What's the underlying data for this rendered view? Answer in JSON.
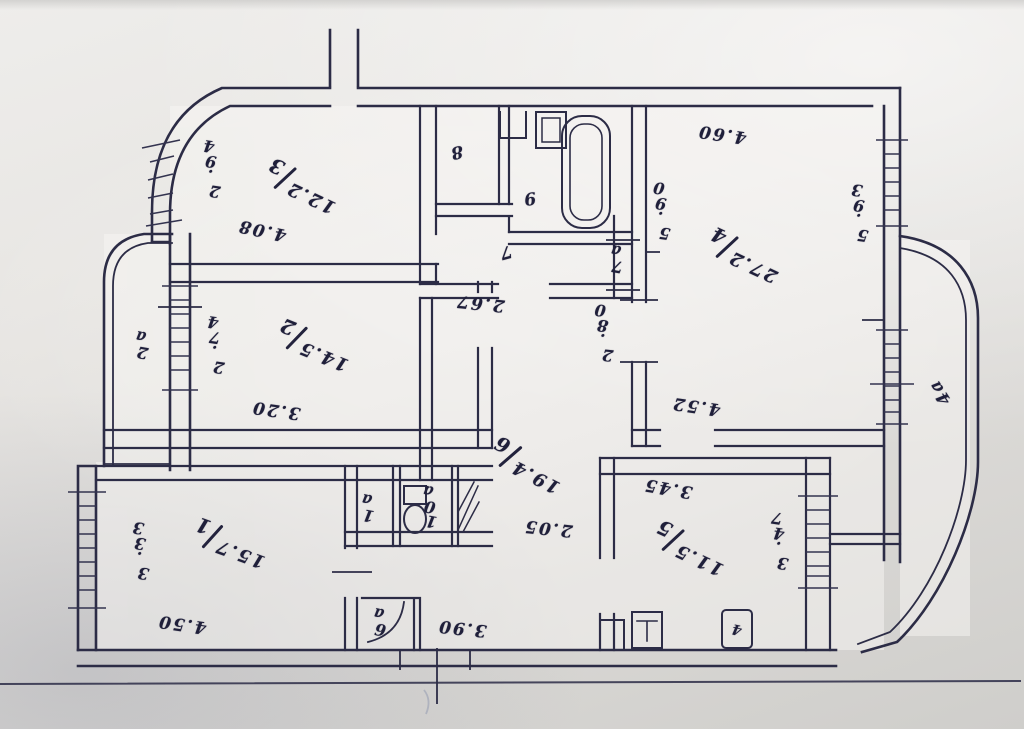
{
  "colors": {
    "ink": "#2c2c46",
    "ink_text": "#1f1f3a",
    "paper_light": "#eeedeb",
    "paper_dark": "#cfcecb"
  },
  "orientation_note": "all handwriting appears rotated 180 degrees (photo upside down)",
  "rooms": [
    {
      "number": "1",
      "area": "15.7",
      "dims": [
        "3.33",
        "4.50"
      ]
    },
    {
      "number": "2",
      "area": "14.5",
      "dims": [
        "2.74",
        "3.20"
      ]
    },
    {
      "number": "3",
      "area": "12.2",
      "dims": [
        "2.94",
        "4.08"
      ]
    },
    {
      "number": "4",
      "area": "27.2",
      "dims": [
        "4.60",
        "5.90",
        "5.93"
      ]
    },
    {
      "number": "5",
      "area": "11.5",
      "dims": [
        "3.45",
        "3.47"
      ]
    },
    {
      "number": "6",
      "area": "19.4",
      "dims": [
        "2.67",
        "2.80",
        "2.05",
        "3.90",
        "4.52"
      ]
    },
    {
      "number": "7"
    },
    {
      "number": "8"
    },
    {
      "number": "9"
    }
  ],
  "annexes": [
    "1a",
    "2a",
    "4a",
    "6a",
    "7a",
    "10a"
  ],
  "fixtures": [
    "bathtub",
    "washbasin",
    "toilet",
    "kitchen-sink",
    "kitchen-stove",
    "ventilation-shaft",
    "stove-box-4"
  ],
  "labels": [
    {
      "name": "room-3-number-area",
      "type": "fraction",
      "num": "3",
      "den": "12.2",
      "x": 302,
      "y": 186,
      "rot": 205
    },
    {
      "name": "room-3-dim-left",
      "type": "stack",
      "text": "2.94",
      "x": 212,
      "y": 168,
      "tilt": 8
    },
    {
      "name": "room-3-dim-bottom",
      "type": "plain",
      "text": "4.08",
      "x": 262,
      "y": 230,
      "rot": 192
    },
    {
      "name": "room-8-number",
      "type": "plain",
      "text": "8",
      "x": 456,
      "y": 152,
      "rot": 168
    },
    {
      "name": "room-9-number",
      "type": "plain",
      "text": "9",
      "x": 529,
      "y": 198,
      "rot": 172
    },
    {
      "name": "corridor-7-number",
      "type": "plain",
      "text": "7",
      "x": 505,
      "y": 252,
      "rot": 165
    },
    {
      "name": "closet-7a-label",
      "type": "stack",
      "text": "7a",
      "x": 617,
      "y": 258,
      "tilt": 10
    },
    {
      "name": "hall-dim-2-67",
      "type": "plain",
      "text": "2.67",
      "x": 480,
      "y": 303,
      "rot": 186
    },
    {
      "name": "hall-dim-2-80",
      "type": "stack",
      "text": "2.80",
      "x": 604,
      "y": 332,
      "tilt": 6
    },
    {
      "name": "room-4-number-area",
      "type": "fraction",
      "num": "4",
      "den": "27.2",
      "x": 744,
      "y": 255,
      "rot": 205
    },
    {
      "name": "room-4-dim-top",
      "type": "plain",
      "text": "4.60",
      "x": 722,
      "y": 134,
      "rot": 188
    },
    {
      "name": "room-4-dim-left",
      "type": "stack",
      "text": "5.90",
      "x": 662,
      "y": 210,
      "tilt": 8
    },
    {
      "name": "room-4-dim-right",
      "type": "stack",
      "text": "5.93",
      "x": 860,
      "y": 212,
      "tilt": 8
    },
    {
      "name": "balcony-4a-label",
      "type": "plain",
      "text": "4a",
      "x": 940,
      "y": 392,
      "rot": 237
    },
    {
      "name": "balcony-2a-label",
      "type": "stack",
      "text": "2a",
      "x": 142,
      "y": 344,
      "tilt": 10
    },
    {
      "name": "room-2-number-area",
      "type": "fraction",
      "num": "2",
      "den": "14.5",
      "x": 314,
      "y": 345,
      "rot": 202
    },
    {
      "name": "room-2-dim-left",
      "type": "stack",
      "text": "2.74",
      "x": 216,
      "y": 344,
      "tilt": 8
    },
    {
      "name": "room-2-dim-bottom",
      "type": "plain",
      "text": "3.20",
      "x": 276,
      "y": 410,
      "rot": 188
    },
    {
      "name": "hall-6-number-area",
      "type": "fraction",
      "num": "6",
      "den": "19.4",
      "x": 527,
      "y": 465,
      "rot": 207
    },
    {
      "name": "passage-dim-4-52",
      "type": "plain",
      "text": "4.52",
      "x": 696,
      "y": 406,
      "rot": 188
    },
    {
      "name": "kitchen-dim-top",
      "type": "plain",
      "text": "3.45",
      "x": 668,
      "y": 488,
      "rot": 190
    },
    {
      "name": "kitchen-5-number-area",
      "type": "fraction",
      "num": "5",
      "den": "11.5",
      "x": 690,
      "y": 548,
      "rot": 205
    },
    {
      "name": "kitchen-dim-right",
      "type": "stack",
      "text": "3.47",
      "x": 780,
      "y": 540,
      "tilt": 8
    },
    {
      "name": "hall-dim-2-05",
      "type": "plain",
      "text": "2.05",
      "x": 548,
      "y": 528,
      "rot": 186
    },
    {
      "name": "room-1-number-area",
      "type": "fraction",
      "num": "1",
      "den": "15.7",
      "x": 230,
      "y": 543,
      "rot": 200
    },
    {
      "name": "room-1-dim-left",
      "type": "stack",
      "text": "3.33",
      "x": 141,
      "y": 550,
      "tilt": 9
    },
    {
      "name": "room-1-dim-bottom",
      "type": "plain",
      "text": "4.50",
      "x": 182,
      "y": 624,
      "rot": 188
    },
    {
      "name": "closet-1a-label",
      "type": "stack",
      "text": "1a",
      "x": 368,
      "y": 507,
      "tilt": 10
    },
    {
      "name": "wc-10a-label",
      "type": "stack",
      "text": "10a",
      "x": 430,
      "y": 506,
      "tilt": 10
    },
    {
      "name": "closet-6a-label",
      "type": "stack",
      "text": "6a",
      "x": 380,
      "y": 621,
      "tilt": 10
    },
    {
      "name": "entry-dim-3-90",
      "type": "plain",
      "text": "3.90",
      "x": 462,
      "y": 628,
      "rot": 186
    },
    {
      "name": "stove-box-label",
      "type": "plain small",
      "text": "4",
      "x": 737,
      "y": 629,
      "rot": 192
    }
  ]
}
